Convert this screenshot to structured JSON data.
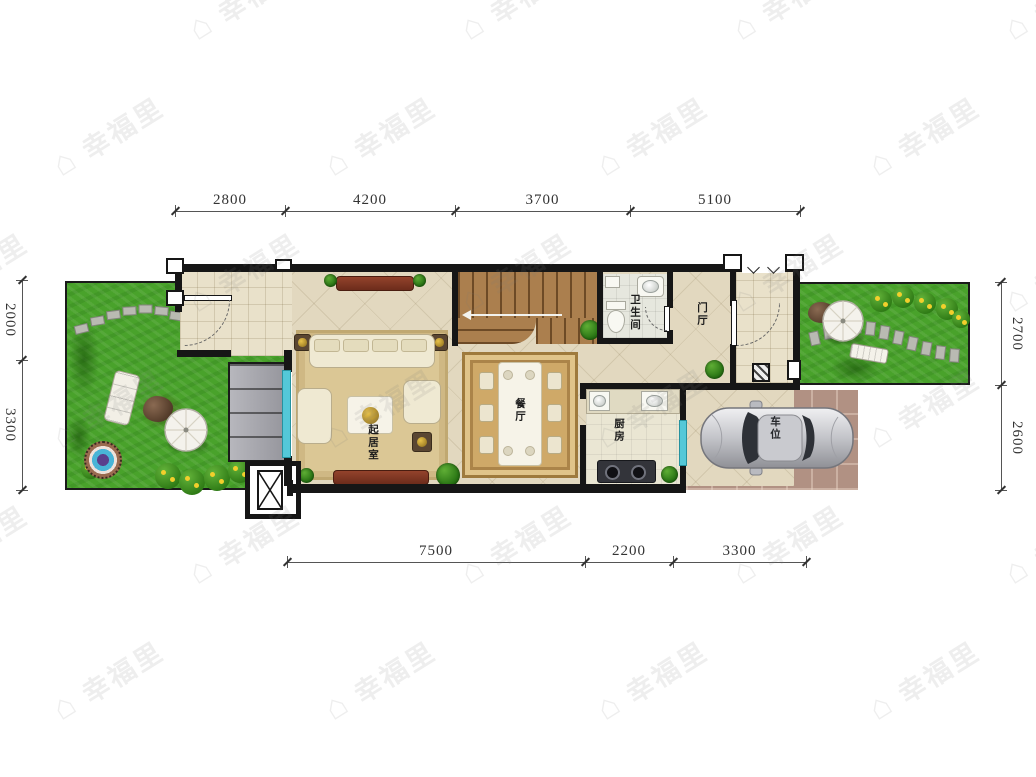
{
  "watermark": {
    "text": "幸福里"
  },
  "dimensions": {
    "top": [
      "2800",
      "4200",
      "3700",
      "5100"
    ],
    "bottom": [
      "7500",
      "2200",
      "3300"
    ],
    "left": [
      "2000",
      "3300"
    ],
    "right": [
      "2700",
      "2600"
    ]
  },
  "rooms": {
    "living": "起居室",
    "dining": "餐厅",
    "kitchen": "厨房",
    "bath": "卫生间",
    "hall": "门厅",
    "parking": "车位"
  },
  "colors": {
    "wall": "#161616",
    "window_glass": "#54c8d8",
    "grass": "#49a22b",
    "floor": "#e2d8bf",
    "stair_wood": "#ab7f4e",
    "parking_tile": "#b19183",
    "dining_rug": "#cfa968"
  }
}
